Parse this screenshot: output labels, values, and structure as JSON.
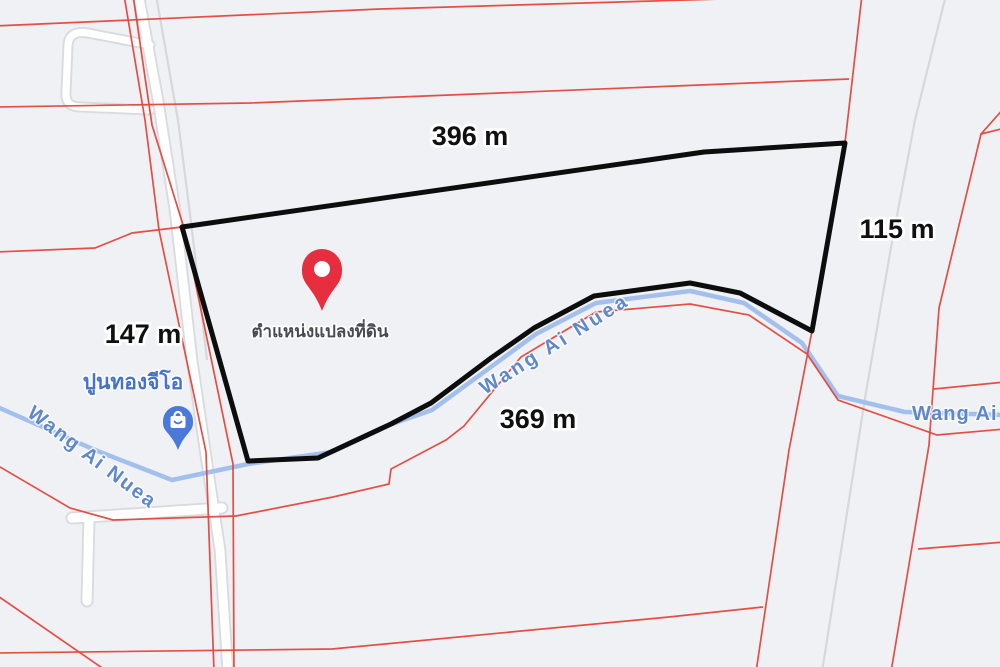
{
  "map": {
    "measurements": {
      "top": "396 m",
      "right": "115 m",
      "left": "147 m",
      "bottom": "369 m"
    },
    "parcel_pin": {
      "caption": "ตำแหน่งแปลงที่ดิน",
      "color": "#e62e3e",
      "icon": "map-pin-icon"
    },
    "poi": {
      "label": "ปูนทองจีโอ",
      "color": "#4a79d9",
      "icon": "shopping-bag-icon"
    },
    "waterway": {
      "label_left": "Wang Ai Nuea",
      "label_middle": "Wang Ai Nuea",
      "label_right": "Wang Ai Nuea",
      "line_color": "#a3bfec",
      "label_color": "#5e88c9"
    },
    "colors": {
      "background": "#eff1f4",
      "parcel_outline": "#0d0d0d",
      "cadastral_line": "#e5453b",
      "road_fill": "#ffffff",
      "road_casing": "#d9dbdf",
      "measurement_text": "#101010"
    }
  }
}
